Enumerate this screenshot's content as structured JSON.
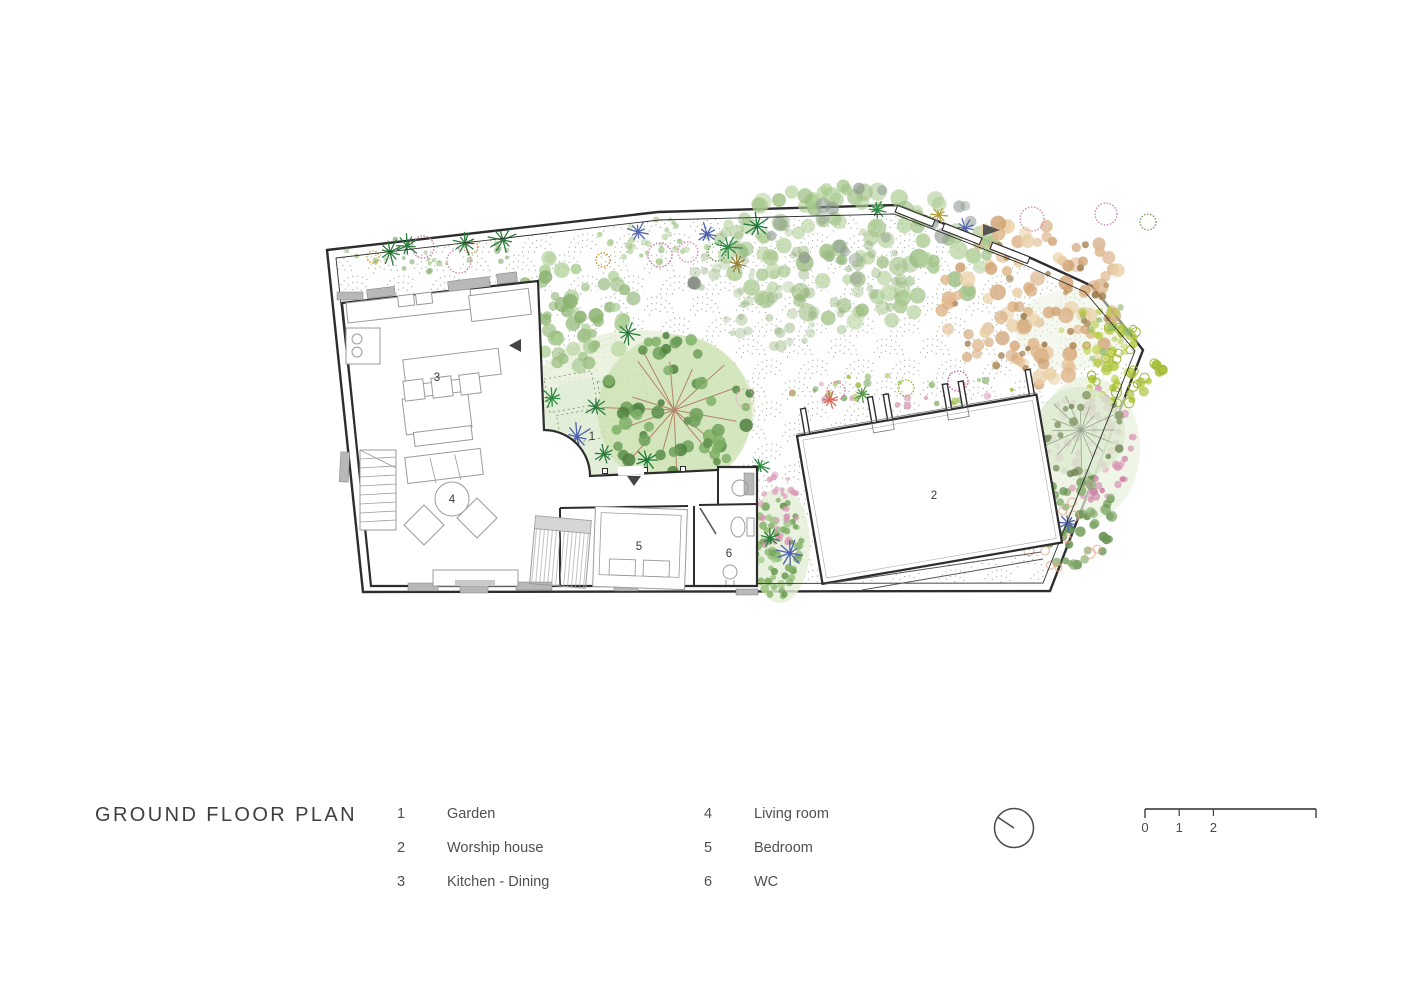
{
  "page_title": "GROUND FLOOR PLAN",
  "legend": {
    "items": [
      {
        "num": "1",
        "label": "Garden"
      },
      {
        "num": "2",
        "label": "Worship house"
      },
      {
        "num": "3",
        "label": "Kitchen - Dining"
      },
      {
        "num": "4",
        "label": "Living room"
      },
      {
        "num": "5",
        "label": "Bedroom"
      },
      {
        "num": "6",
        "label": "WC"
      }
    ]
  },
  "plan": {
    "room_labels": [
      {
        "num": "1",
        "x": 592,
        "y": 440
      },
      {
        "num": "2",
        "x": 934,
        "y": 499
      },
      {
        "num": "3",
        "x": 437,
        "y": 381
      },
      {
        "num": "4",
        "x": 452,
        "y": 503
      },
      {
        "num": "5",
        "x": 639,
        "y": 550
      },
      {
        "num": "6",
        "x": 729,
        "y": 557
      }
    ]
  },
  "scale_bar": {
    "ticks": [
      "0",
      "1",
      "2",
      "5"
    ]
  },
  "colors": {
    "wall": "#2d2d2d",
    "title_text": "#3f3f3f",
    "legend_text": "#4f4f4f",
    "garden_dot": "#8d9c85",
    "canopy_green": "#a3c489",
    "canopy_orange": "#e0b88c",
    "flower_pink": "#d795b3",
    "palm_green": "#2d7a3e",
    "palm_blue": "#4d5fae"
  }
}
